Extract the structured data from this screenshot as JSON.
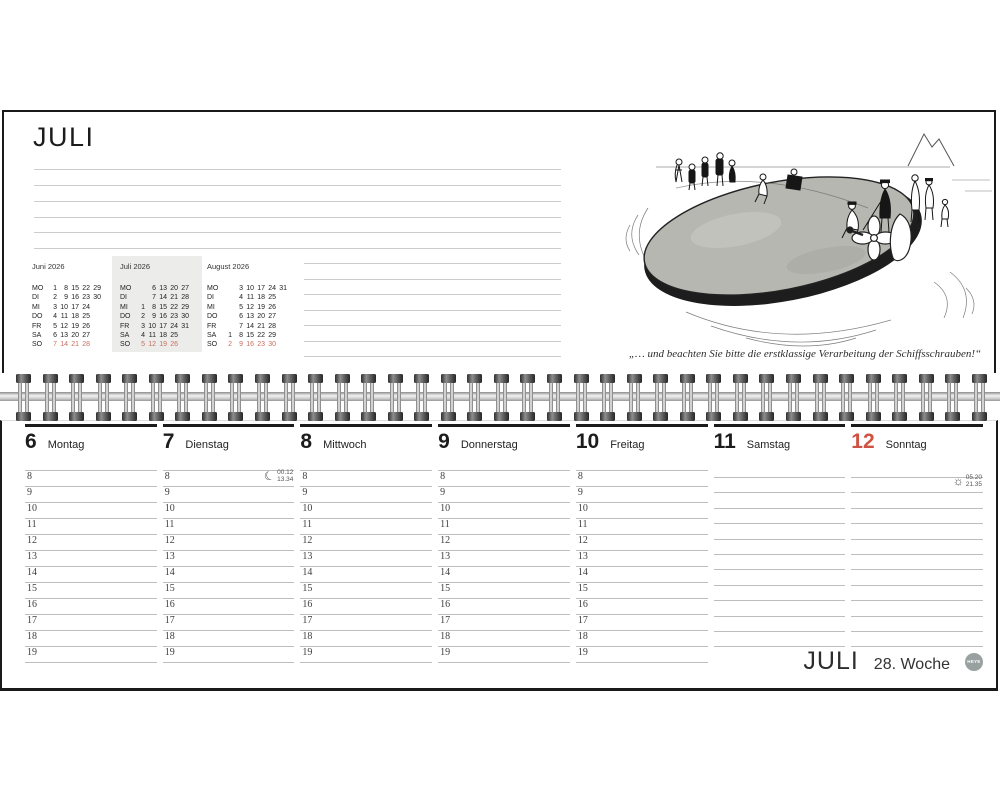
{
  "top_page": {
    "title": "JULI",
    "mini_calendars": [
      {
        "title": "Juni 2026",
        "highlighted": false,
        "rows": [
          {
            "label": "MO",
            "cells": [
              "1",
              "8",
              "15",
              "22",
              "29",
              ""
            ]
          },
          {
            "label": "DI",
            "cells": [
              "2",
              "9",
              "16",
              "23",
              "30",
              ""
            ]
          },
          {
            "label": "MI",
            "cells": [
              "3",
              "10",
              "17",
              "24",
              "",
              ""
            ]
          },
          {
            "label": "DO",
            "cells": [
              "4",
              "11",
              "18",
              "25",
              "",
              ""
            ]
          },
          {
            "label": "FR",
            "cells": [
              "5",
              "12",
              "19",
              "26",
              "",
              ""
            ]
          },
          {
            "label": "SA",
            "cells": [
              "6",
              "13",
              "20",
              "27",
              "",
              ""
            ]
          },
          {
            "label": "SO",
            "cells": [
              "7",
              "14",
              "21",
              "28",
              "",
              ""
            ]
          }
        ]
      },
      {
        "title": "Juli 2026",
        "highlighted": true,
        "rows": [
          {
            "label": "MO",
            "cells": [
              "",
              "6",
              "13",
              "20",
              "27",
              ""
            ]
          },
          {
            "label": "DI",
            "cells": [
              "",
              "7",
              "14",
              "21",
              "28",
              ""
            ]
          },
          {
            "label": "MI",
            "cells": [
              "1",
              "8",
              "15",
              "22",
              "29",
              ""
            ]
          },
          {
            "label": "DO",
            "cells": [
              "2",
              "9",
              "16",
              "23",
              "30",
              ""
            ]
          },
          {
            "label": "FR",
            "cells": [
              "3",
              "10",
              "17",
              "24",
              "31",
              ""
            ]
          },
          {
            "label": "SA",
            "cells": [
              "4",
              "11",
              "18",
              "25",
              "",
              ""
            ]
          },
          {
            "label": "SO",
            "cells": [
              "5",
              "12",
              "19",
              "26",
              "",
              ""
            ]
          }
        ]
      },
      {
        "title": "August 2026",
        "highlighted": false,
        "rows": [
          {
            "label": "MO",
            "cells": [
              "",
              "3",
              "10",
              "17",
              "24",
              "31"
            ]
          },
          {
            "label": "DI",
            "cells": [
              "",
              "4",
              "11",
              "18",
              "25",
              ""
            ]
          },
          {
            "label": "MI",
            "cells": [
              "",
              "5",
              "12",
              "19",
              "26",
              ""
            ]
          },
          {
            "label": "DO",
            "cells": [
              "",
              "6",
              "13",
              "20",
              "27",
              ""
            ]
          },
          {
            "label": "FR",
            "cells": [
              "",
              "7",
              "14",
              "21",
              "28",
              ""
            ]
          },
          {
            "label": "SA",
            "cells": [
              "1",
              "8",
              "15",
              "22",
              "29",
              ""
            ]
          },
          {
            "label": "SO",
            "cells": [
              "2",
              "9",
              "16",
              "23",
              "30",
              ""
            ]
          }
        ]
      }
    ],
    "caption": "„… und beachten Sie bitte die erstklassige Verarbeitung der Schiffsschrauben!“"
  },
  "bottom_page": {
    "hours": [
      "8",
      "9",
      "10",
      "11",
      "12",
      "13",
      "14",
      "15",
      "16",
      "17",
      "18",
      "19"
    ],
    "days": [
      {
        "number": "6",
        "name": "Montag",
        "sunday": false,
        "blank": false
      },
      {
        "number": "7",
        "name": "Dienstag",
        "sunday": false,
        "blank": false,
        "moon": {
          "rise": "00.12",
          "set": "13.34"
        }
      },
      {
        "number": "8",
        "name": "Mittwoch",
        "sunday": false,
        "blank": false
      },
      {
        "number": "9",
        "name": "Donnerstag",
        "sunday": false,
        "blank": false
      },
      {
        "number": "10",
        "name": "Freitag",
        "sunday": false,
        "blank": false
      },
      {
        "number": "11",
        "name": "Samstag",
        "sunday": false,
        "blank": true
      },
      {
        "number": "12",
        "name": "Sonntag",
        "sunday": true,
        "blank": true,
        "sun": {
          "rise": "05.20",
          "set": "21.35"
        }
      }
    ],
    "footer": {
      "month": "JULI",
      "week": "28. Woche",
      "logo": "HEYE"
    }
  },
  "icons": {
    "moon_glyph": "☾",
    "sun_glyph": "☼"
  },
  "colors": {
    "accent_red": "#cf5342",
    "minical_sunday_red": "#c96e5d",
    "minical_highlight_bg": "#ececea",
    "logo_bg": "#99a0a0"
  }
}
